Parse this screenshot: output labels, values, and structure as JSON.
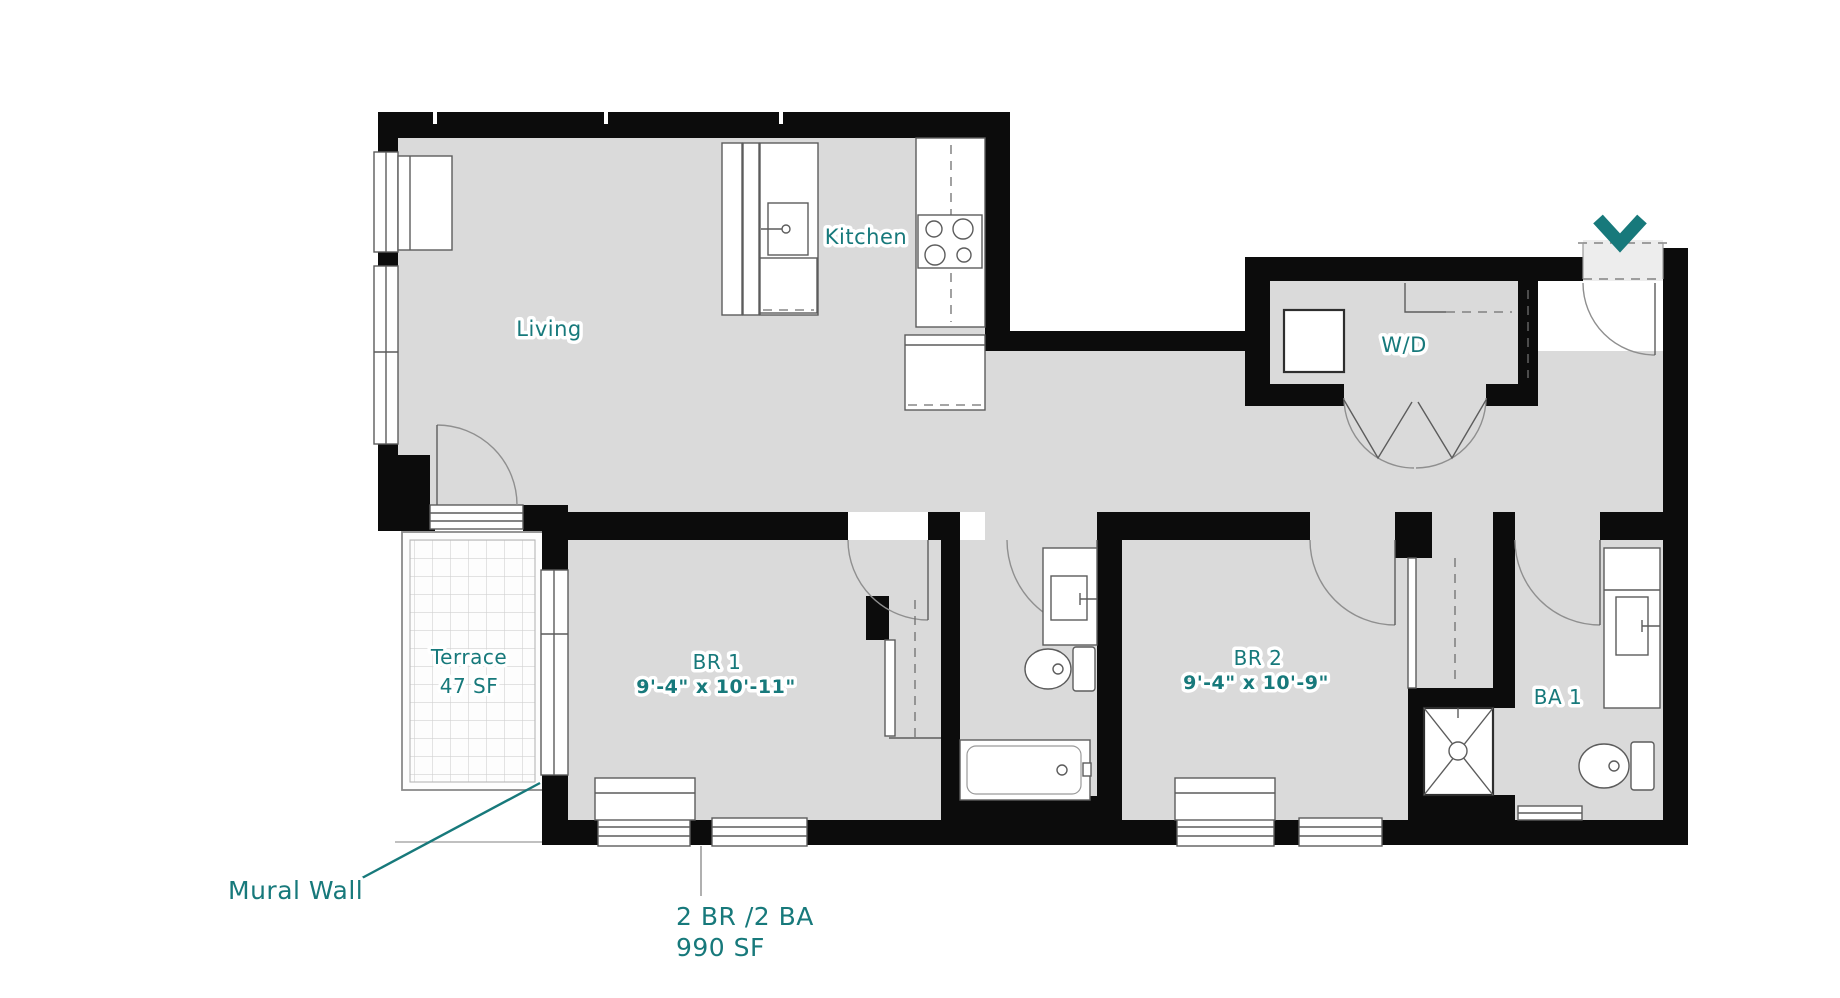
{
  "plan": {
    "rooms": {
      "living": {
        "label": "Living"
      },
      "kitchen": {
        "label": "Kitchen"
      },
      "laundry": {
        "label": "W/D"
      },
      "terrace": {
        "label": "Terrace",
        "area": "47 SF"
      },
      "br1": {
        "label": "BR 1",
        "dims": "9'-4\" x 10'-11\""
      },
      "br2": {
        "label": "BR 2",
        "dims": "9'-4\" x 10'-9\""
      },
      "ba1": {
        "label": "BA 1"
      }
    },
    "annotations": {
      "mural_wall": "Mural Wall"
    },
    "unit": {
      "beds_baths": "2 BR /2 BA",
      "area": "990 SF"
    },
    "icons": {
      "entry_marker": "chevron-down-icon"
    },
    "colors": {
      "accent_teal": "#17797b",
      "wall_black": "#0c0c0c",
      "floor_gray": "#dadada"
    }
  }
}
